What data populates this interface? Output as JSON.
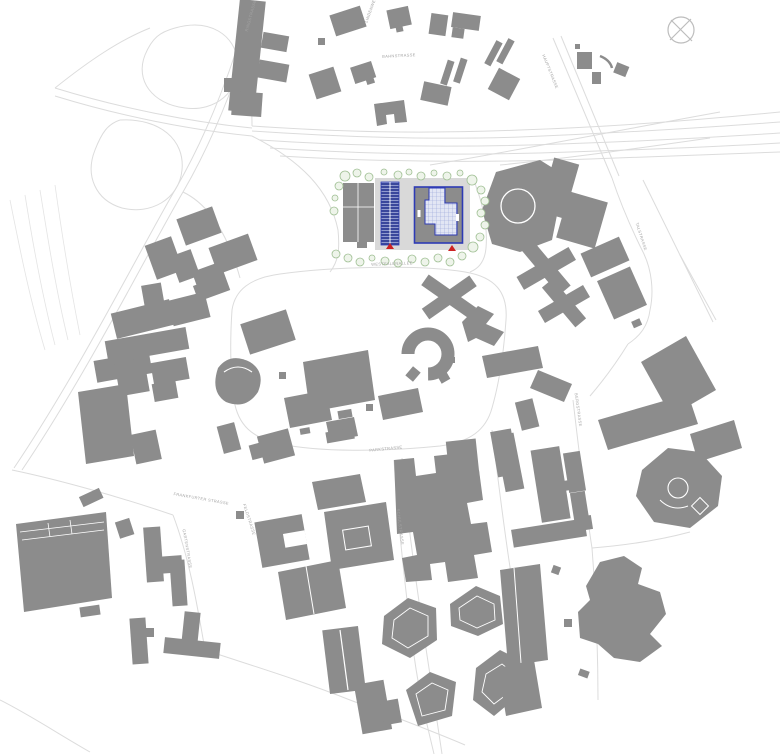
{
  "map": {
    "type": "architectural-site-plan",
    "street_labels": [
      {
        "text": "BAHNSTRASSE"
      },
      {
        "text": "LINDENWEG"
      },
      {
        "text": "RINGSTRASSE"
      },
      {
        "text": "HAUPTSTRASSE"
      },
      {
        "text": "WESTFALENALLEE"
      },
      {
        "text": "PARKSTRASSE"
      },
      {
        "text": "SCHULSTRASSE"
      },
      {
        "text": "FRANKFURTER STRASSE"
      },
      {
        "text": "GARTENSTRASSE"
      },
      {
        "text": "FELDSTRASSE"
      },
      {
        "text": "TALSTRASSE"
      },
      {
        "text": "BERGSTRASSE"
      }
    ],
    "icons": [
      {
        "name": "compass-north-icon",
        "shape": "circle-with-x"
      }
    ],
    "colors": {
      "background": "#ffffff",
      "building_gray": "#8c8c8c",
      "road_line": "#dcdcdc",
      "site_plaza": "#d9d9d9",
      "site_accent_blue": "#2e3bb5",
      "solar_panel_blue": "#3a479b",
      "courtyard_hatch_bg": "#e2e6f4",
      "courtyard_hatch_line": "#96a2d8",
      "tree_green": "#9fbf93",
      "entrance_marker_red": "#cc2222",
      "label_gray": "#a3a3a3",
      "north_symbol_gray": "#bdbdbd"
    },
    "site_markers": {
      "entrance_marker_count": 2
    }
  }
}
